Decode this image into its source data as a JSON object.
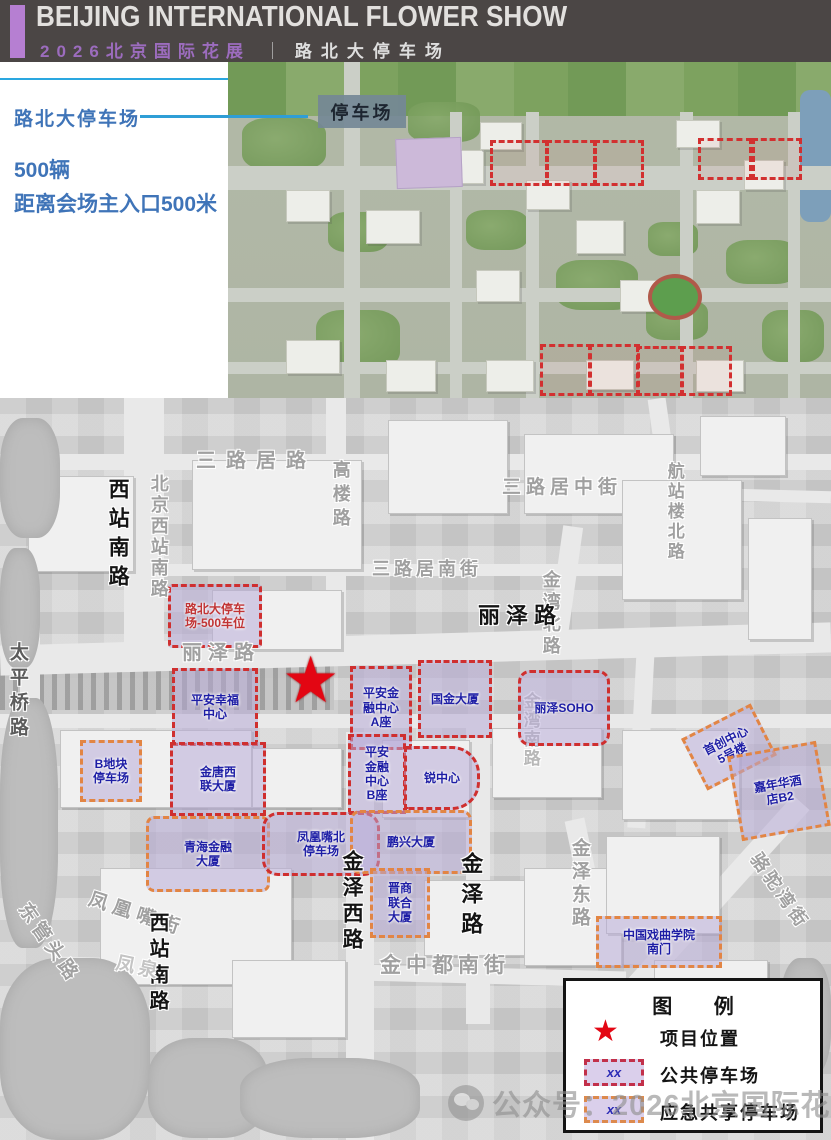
{
  "header": {
    "title": "BEIJING INTERNATIONAL FLOWER SHOW",
    "subtitle_cn": "2026北京国际花展",
    "divider": "｜",
    "section": "路北大停车场"
  },
  "info_panel": {
    "site_label": "路北大停车场",
    "capacity": "500辆",
    "distance": "距离会场主入口500米"
  },
  "aerial_map": {
    "parking_label": "停车场"
  },
  "map": {
    "star": "★",
    "roads": {
      "sanlujulu": "三路居路",
      "sanlujuzhongjie": "三路居中街",
      "hangzhanloubeilu": "航站楼北路",
      "xizhannanlu_n": "西站南路",
      "beijingxizhannanlu": "北京西站南路",
      "gaoloulu": "高楼路",
      "sanlujunanjie": "三路居南街",
      "jinwanbeilu": "金湾北路",
      "lizelu_w": "丽泽路",
      "lizelu_e": "丽泽路",
      "taipingqiaolu": "太平桥路",
      "jinwannanlu": "金湾南路",
      "jinzexilu": "金泽西路",
      "jinzelu": "金泽路",
      "jinzedonglu": "金泽东路",
      "jinzhongdunanjie": "金中都南街",
      "dongguantoulu": "东管头路",
      "fenghuangzuijie": "凤凰嘴街",
      "xizhannanlu_s": "西站南路",
      "fengquan": "凤泉",
      "luotuowanjie": "骆驼湾街"
    },
    "zones": {
      "lubei": "路北大停车\n场-500车位",
      "pingan_xingfu": "平安幸福\n中心",
      "pingan_jinrong_a": "平安金\n融中心\nA座",
      "guojin": "国金大厦",
      "lize_soho": "丽泽SOHO",
      "jintang": "金唐西\n联大厦",
      "b_dikuai": "B地块\n停车场",
      "pingan_jinrong_b": "平安\n金融\n中心\nB座",
      "rui_center": "锐中心",
      "shouchuang": "首创中心\n5号楼",
      "jianianhua": "嘉年华酒\n店B2",
      "qinghai": "青海金融\n大厦",
      "fenghuangzui": "凤凰嘴北\n停车场",
      "pengxing": "鹏兴大厦",
      "jinshang": "晋商\n联合\n大厦",
      "xiqu": "中国戏曲学院\n南门"
    }
  },
  "legend": {
    "title": "图  例",
    "items": [
      {
        "symbol": "★",
        "label": "项目位置"
      },
      {
        "symbol": "xx",
        "label": "公共停车场"
      },
      {
        "symbol": "xx",
        "label": "应急共享停车场"
      }
    ]
  },
  "watermark": {
    "text": "公众号：2026北京国际花展"
  },
  "colors": {
    "accent_purple": "#b67fd2",
    "info_text_blue": "#3f74b8",
    "zone_fill": "#b6a8d6",
    "public_parking_border": "#cf2f2f",
    "emergency_parking_border": "#e28544",
    "zone_label_blue": "#1d1da5",
    "star_red": "#e30613"
  }
}
